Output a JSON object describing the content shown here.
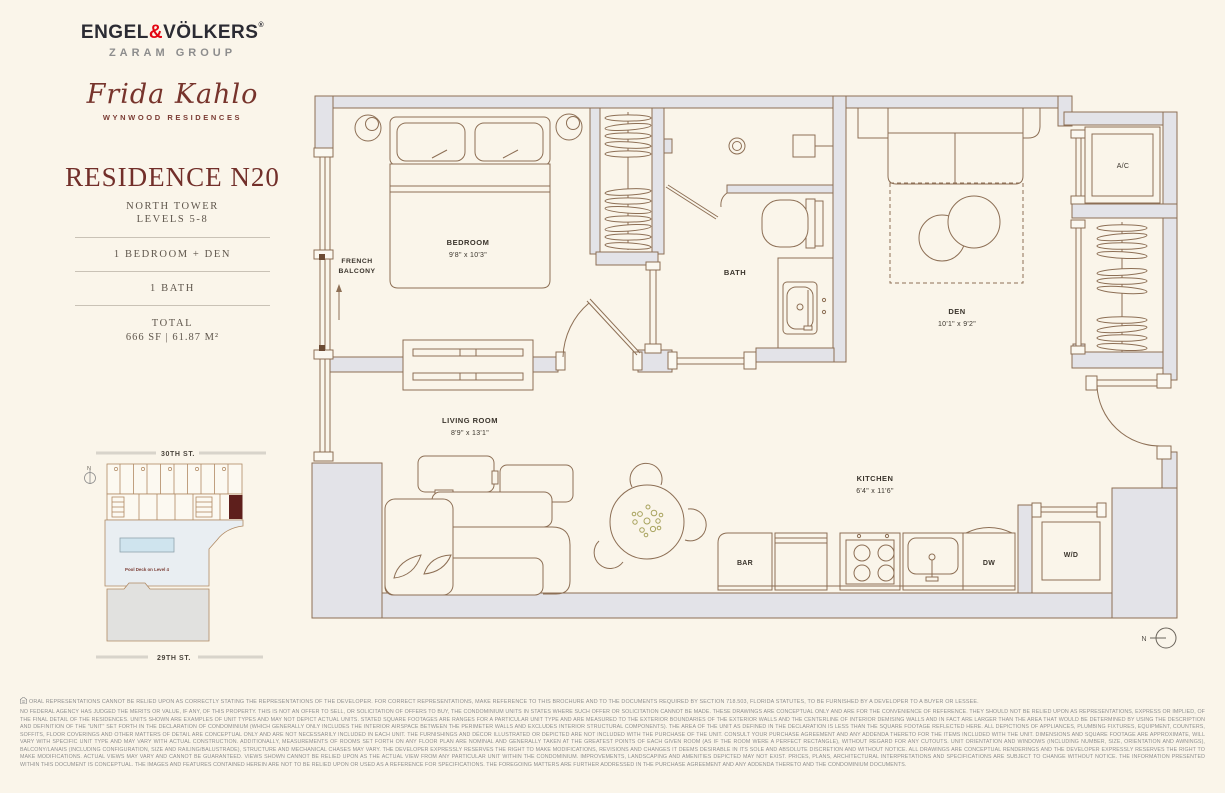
{
  "brand": {
    "engel": "ENGEL",
    "amp": "&",
    "volkers": "VÖLKERS",
    "registered": "®",
    "group": "ZARAM GROUP",
    "project_script": "Frida Kahlo",
    "project_sub": "WYNWOOD RESIDENCES"
  },
  "residence": {
    "title": "RESIDENCE N20",
    "tower": "NORTH TOWER",
    "levels": "LEVELS 5-8",
    "bedrooms": "1 BEDROOM + DEN",
    "baths": "1 BATH",
    "total_label": "TOTAL",
    "total_value": "666 SF | 61.87 M²"
  },
  "sitemap": {
    "street_top": "30TH ST.",
    "street_bottom": "29TH ST.",
    "pool_label": "Pool Deck on Level 4",
    "north_label": "N"
  },
  "floorplan": {
    "north_label": "N",
    "rooms": {
      "bedroom": {
        "name": "BEDROOM",
        "dims": "9'8\" x 10'3\""
      },
      "french_line1": "FRENCH",
      "french_line2": "BALCONY",
      "bath": {
        "name": "BATH"
      },
      "den": {
        "name": "DEN",
        "dims": "10'1\" x 9'2\""
      },
      "living": {
        "name": "LIVING ROOM",
        "dims": "8'9\" x 13'1\""
      },
      "kitchen": {
        "name": "KITCHEN",
        "dims": "6'4\" x 11'6\""
      },
      "ac": "A/C",
      "bar": "BAR",
      "dw": "DW",
      "wd": "W/D"
    }
  },
  "disclaimer": {
    "line1": "ORAL REPRESENTATIONS CANNOT BE RELIED UPON AS CORRECTLY STATING THE REPRESENTATIONS OF THE DEVELOPER. FOR CORRECT REPRESENTATIONS, MAKE REFERENCE TO THIS BROCHURE AND TO THE DOCUMENTS REQUIRED BY SECTION 718.503, FLORIDA STATUTES, TO BE FURNISHED BY A DEVELOPER TO A BUYER OR LESSEE.",
    "body": "NO FEDERAL AGENCY HAS JUDGED THE MERITS OR VALUE, IF ANY, OF THIS PROPERTY. THIS IS NOT AN OFFER TO SELL, OR SOLICITATION OF OFFERS TO BUY, THE CONDOMINIUM UNITS IN STATES WHERE SUCH OFFER OR SOLICITATION CANNOT BE MADE. THESE DRAWINGS ARE CONCEPTUAL ONLY AND ARE FOR THE CONVENIENCE OF REFERENCE. THEY SHOULD NOT BE RELIED UPON AS REPRESENTATIONS, EXPRESS OR IMPLIED, OF THE FINAL DETAIL OF THE RESIDENCES. UNITS SHOWN ARE EXAMPLES OF UNIT TYPES AND MAY NOT DEPICT ACTUAL UNITS. STATED SQUARE FOOTAGES ARE RANGES FOR A PARTICULAR UNIT TYPE AND ARE MEASURED TO THE EXTERIOR BOUNDARIES OF THE EXTERIOR WALLS AND THE CENTERLINE OF INTERIOR DEMISING WALLS AND IN FACT ARE LARGER THAN THE AREA THAT WOULD BE DETERMINED BY USING THE DESCRIPTION AND DEFINITION OF THE \"UNIT\" SET FORTH IN THE DECLARATION OF CONDOMINIUM (WHICH GENERALLY ONLY INCLUDES THE INTERIOR AIRSPACE BETWEEN THE PERIMETER WALLS AND EXCLUDES INTERIOR STRUCTURAL COMPONENTS). THE AREA OF THE UNIT AS DEFINED IN THE DECLARATION IS LESS THAN THE SQUARE FOOTAGE REFLECTED HERE. ALL DEPICTIONS OF APPLIANCES, PLUMBING FIXTURES, EQUIPMENT, COUNTERS, SOFFITS, FLOOR COVERINGS AND OTHER MATTERS OF DETAIL ARE CONCEPTUAL ONLY AND ARE NOT NECESSARILY INCLUDED IN EACH UNIT. THE FURNISHINGS AND DÉCOR ILLUSTRATED OR DEPICTED ARE NOT INCLUDED WITH THE PURCHASE OF THE UNIT. CONSULT YOUR PURCHASE AGREEMENT AND ANY ADDENDA THERETO FOR THE ITEMS INCLUDED WITH THE UNIT. DIMENSIONS AND SQUARE FOOTAGE ARE APPROXIMATE, WILL VARY WITH SPECIFIC UNIT TYPE AND MAY VARY WITH ACTUAL CONSTRUCTION. ADDITIONALLY, MEASUREMENTS OF ROOMS SET FORTH ON ANY FLOOR PLAN ARE NOMINAL AND GENERALLY TAKEN AT THE GREATEST POINTS OF EACH GIVEN ROOM (AS IF THE ROOM WERE A PERFECT RECTANGLE), WITHOUT REGARD FOR ANY CUTOUTS. UNIT ORIENTATION AND WINDOWS (INCLUDING NUMBER, SIZE, ORIENTATION AND AWNINGS), BALCONY/LANAIS (INCLUDING CONFIGURATION, SIZE AND RAILING/BALUSTRADE), STRUCTURE AND MECHANICAL CHASES MAY VARY. THE DEVELOPER EXPRESSLY RESERVES THE RIGHT TO MAKE MODIFICATIONS, REVISIONS AND CHANGES IT DEEMS DESIRABLE IN ITS SOLE AND ABSOLUTE DISCRETION AND WITHOUT NOTICE. ALL DRAWINGS ARE CONCEPTUAL RENDERINGS AND THE DEVELOPER EXPRESSLY RESERVES THE RIGHT TO MAKE MODIFICATIONS. ACTUAL VIEWS MAY VARY AND CANNOT BE GUARANTEED. VIEWS SHOWN CANNOT BE RELIED UPON AS THE ACTUAL VIEW FROM ANY PARTICULAR UNIT WITHIN THE CONDOMINIUM. IMPROVEMENTS, LANDSCAPING AND AMENITIES DEPICTED MAY NOT EXIST. PRICES, PLANS, ARCHITECTURAL INTERPRETATIONS AND SPECIFICATIONS ARE SUBJECT TO CHANGE WITHOUT NOTICE. THE INFORMATION PRESENTED WITHIN THIS DOCUMENT IS CONCEPTUAL. THE IMAGES AND FEATURES CONTAINED HEREIN ARE NOT TO BE RELIED UPON OR USED AS A REFERENCE FOR SPECIFICATIONS. THE FOREGOING MATTERS ARE FURTHER ADDRESSED IN THE PURCHASE AGREEMENT AND ANY ADDENDA THERETO AND THE CONDOMINIUM DOCUMENTS."
  },
  "colors": {
    "background": "#faf5ea",
    "maroon": "#722f2a",
    "brand_red": "#e30613",
    "wall_fill": "#e3e3e8",
    "plan_line": "#8d6f55",
    "highlight_unit": "#5e1f1c",
    "pool": "#cfe4ee",
    "deck": "#e9eef2"
  }
}
